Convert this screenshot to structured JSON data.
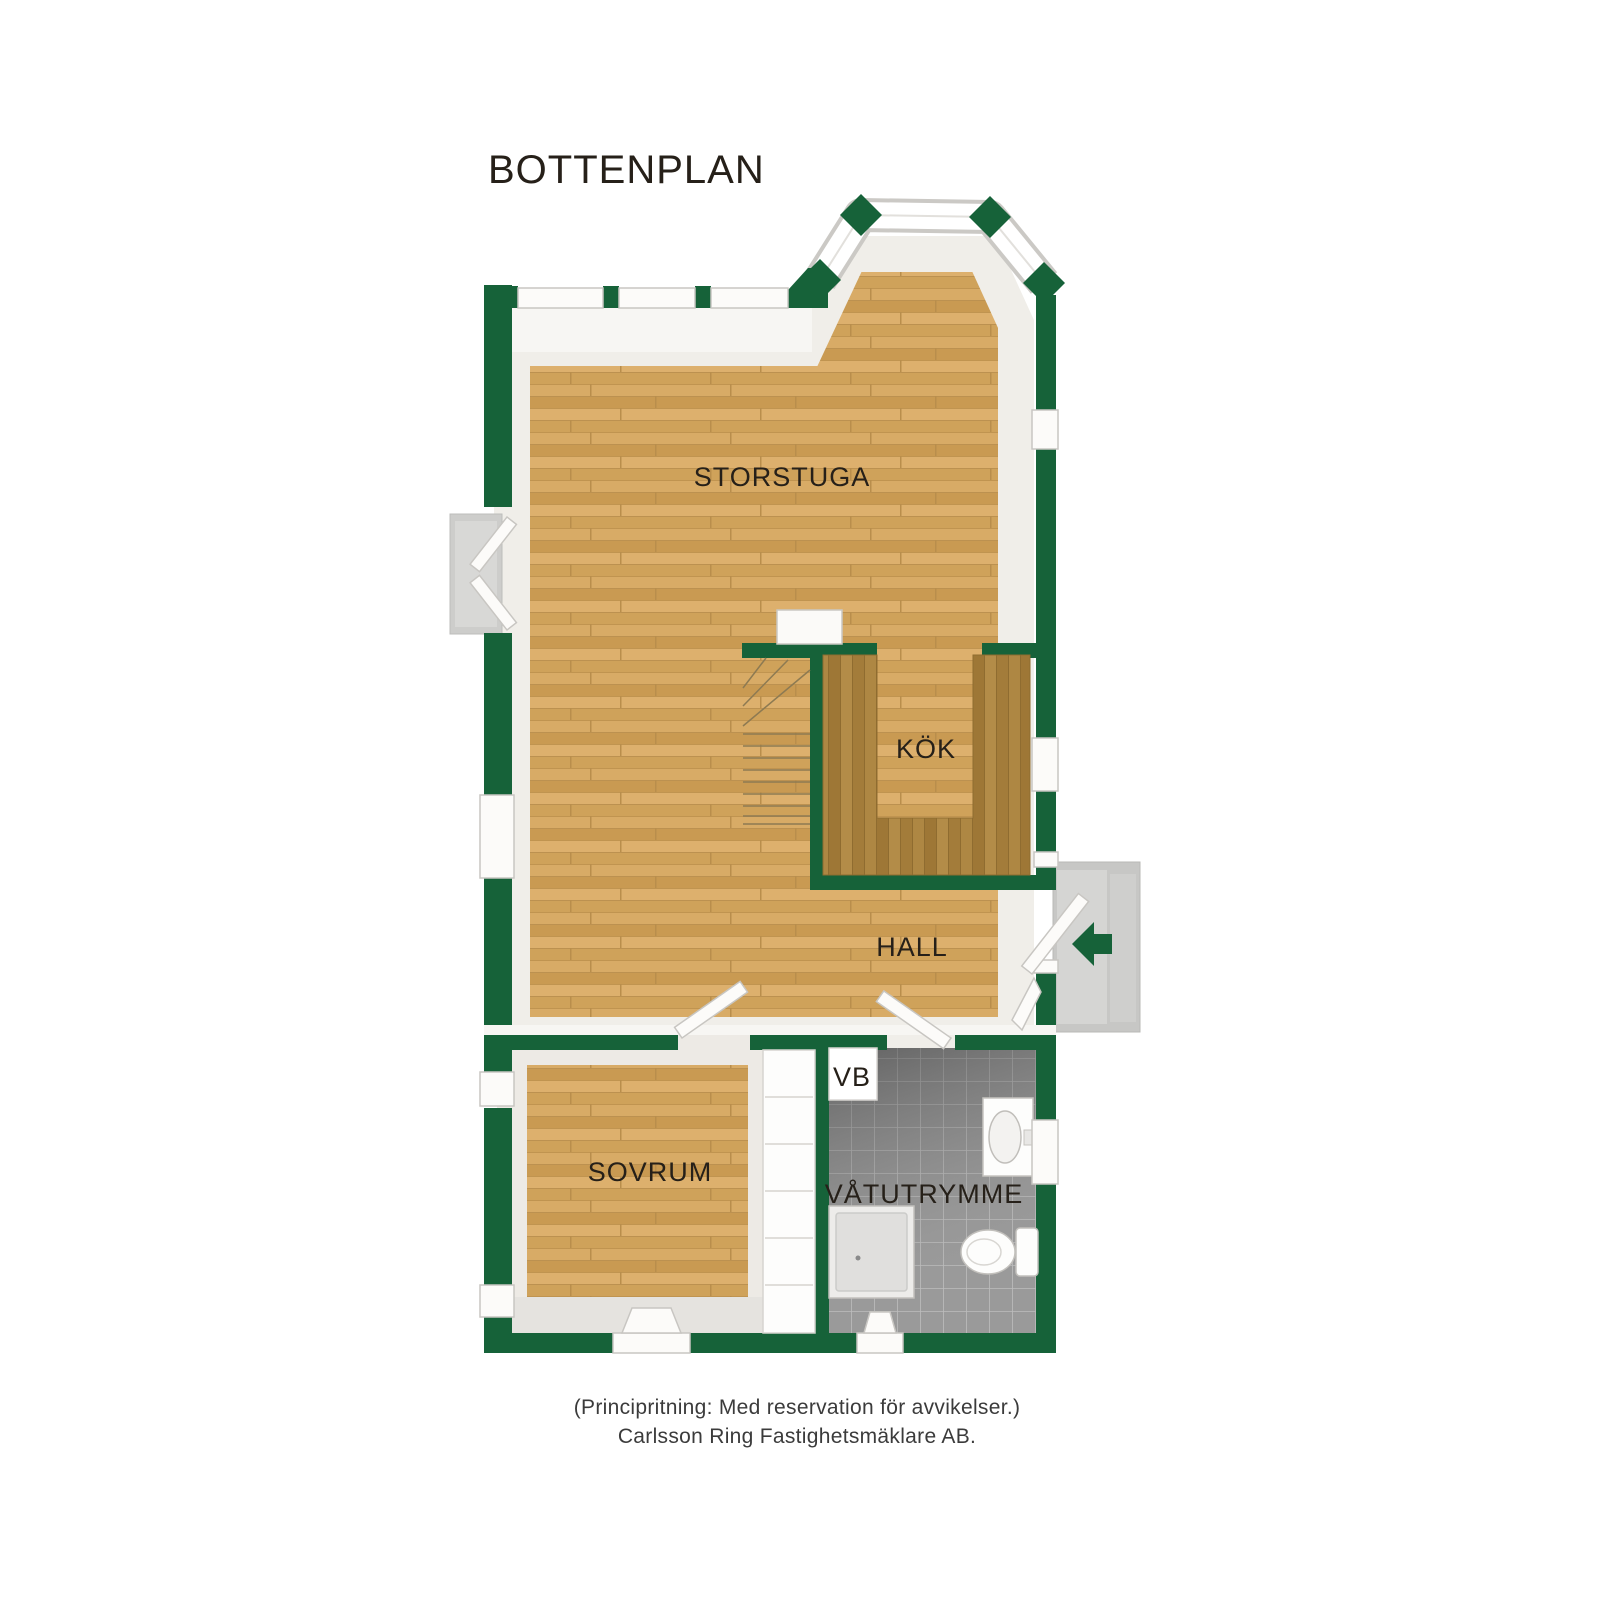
{
  "title": "BOTTENPLAN",
  "rooms": {
    "storstuga": {
      "label": "STORSTUGA"
    },
    "kok": {
      "label": "KÖK"
    },
    "hall": {
      "label": "HALL"
    },
    "sovrum": {
      "label": "SOVRUM"
    },
    "vb": {
      "label": "VB"
    },
    "vatutrymme": {
      "label": "VÅTUTRYMME"
    }
  },
  "footer": {
    "line1": "(Principritning: Med reservation för avvikelser.)",
    "line2": "Carlsson Ring Fastighetsmäklare AB."
  },
  "colors": {
    "wall_green": "#166239",
    "floor_wood": "#D2A55E",
    "counter_wood": "#A8813E",
    "bath_tile": "#9A9A9A",
    "porch_gray": "#C7C7C5",
    "text_dark": "#262019"
  },
  "fixtures": {
    "staircase": "staircase",
    "kitchen_counter": "kitchen-counter",
    "fireplace": "fireplace",
    "wardrobe": "wardrobe",
    "shower": "shower",
    "toilet": "toilet",
    "sink": "sink",
    "entry_arrow": "entry-arrow-left",
    "entry_porch": "entry-porch"
  }
}
